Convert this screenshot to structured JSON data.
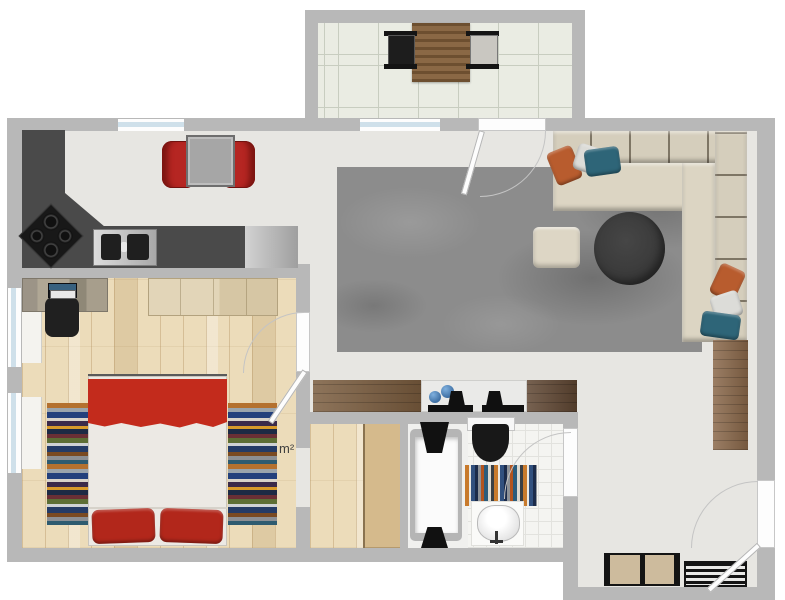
{
  "labels": {
    "area": "m²"
  },
  "palette": {
    "wall": "#b8b8b8",
    "floor_main": "#e7e6e2",
    "floor_wood": "#ecdcba",
    "floor_bath": "#f4f4f1",
    "floor_balcony": "#eaece3",
    "rug": "#8c8c8c",
    "sofa": "#d5cebc",
    "sofa_seat": "#dcd5c3",
    "counter_dark": "#4a4a4a",
    "stainless": "#c6c6c6",
    "bed_red": "#c32b1c",
    "pillow_red": "#b2271b",
    "chair_red": "#b52622",
    "wood": "#8a684a",
    "wood_dark": "#5f4632",
    "closet_tan": "#d5ba8c",
    "pouf": "#ddd6c5",
    "table_dark": "#383838",
    "orange": "#b85c2e",
    "teal": "#2e6578",
    "pillow_white": "#dcdcd8",
    "blue": "#3e6fa3",
    "glass": "#cfe0ea"
  },
  "rooms": [
    "balcony",
    "kitchen-dining",
    "living-room",
    "bedroom",
    "walk-in-closet",
    "bathroom",
    "entry"
  ],
  "objects": [
    "balcony table",
    "balcony chair",
    "dining table",
    "dining chair",
    "kitchen counter",
    "cooktop",
    "sink",
    "sofa",
    "sofa pillow",
    "round coffee table",
    "pouf",
    "area rug",
    "sideboard",
    "tv lowboard",
    "media unit",
    "tall cabinet",
    "bed",
    "bed pillow",
    "bedside runner rug",
    "desk",
    "laptop",
    "office chair",
    "wardrobe",
    "closet",
    "bathtub",
    "toilet",
    "washbasin",
    "bath mat",
    "entry bench",
    "shoe rack"
  ]
}
